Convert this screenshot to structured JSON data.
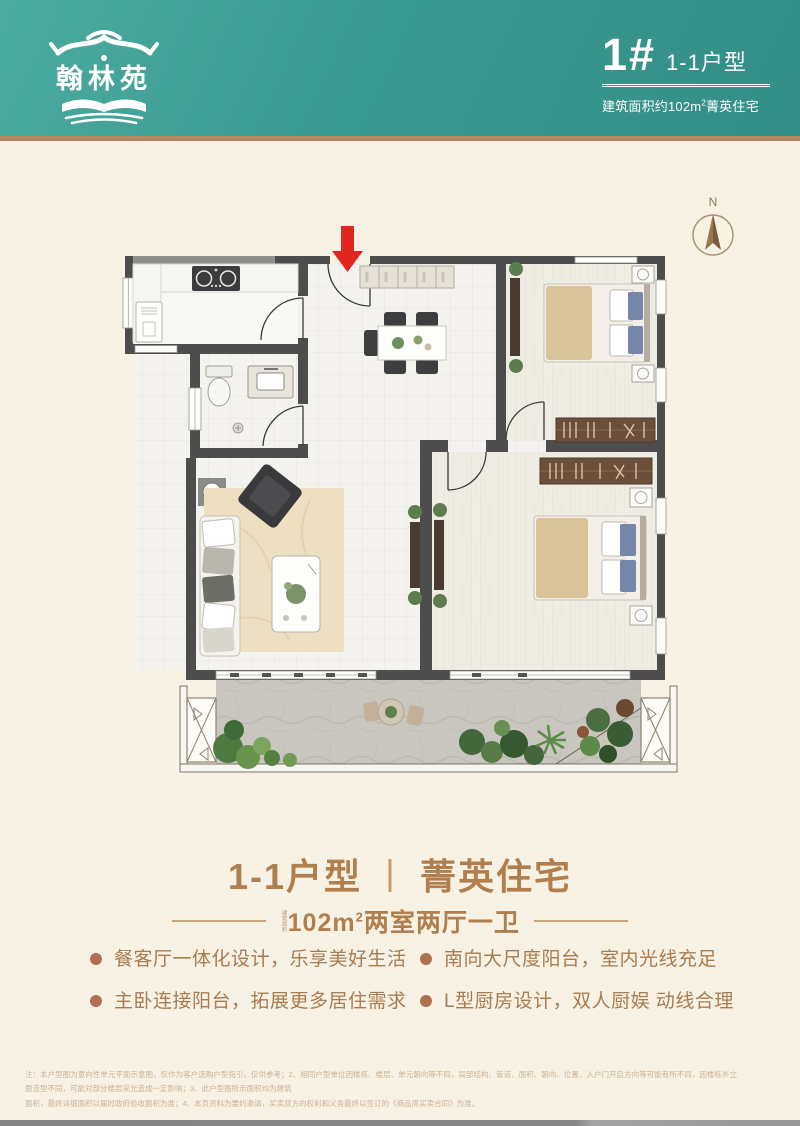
{
  "header": {
    "logo_text": "翰林苑",
    "unit_number": "1#",
    "unit_type": "1-1户型",
    "area_prefix": "建筑面积约102m",
    "area_sup": "2",
    "area_suffix": "菁英住宅"
  },
  "compass": {
    "north": "N"
  },
  "title_block": {
    "name": "1-1户型",
    "divider": "丨",
    "tagline": "菁英住宅",
    "spec_note": "建筑面积",
    "spec_area": "102m",
    "spec_sup": "2",
    "spec_rooms": "两室两厅一卫"
  },
  "features": [
    "餐客厅一体化设计，乐享美好生活",
    "南向大尺度阳台，室内光线充足",
    "主卧连接阳台，拓展更多居住需求",
    "L型厨房设计，双人厨娱 动线合理"
  ],
  "disclaimer": {
    "line1": "注：本户型图为意向性单元平面示意图，仅作为客户选购户型指引，仅供参考；2、相同户型单位因楼栋、楼层、单元朝向等不同，局部结构、管道、面积、朝向、位置、入户门开启方向等可能有所不同，因楼栋外立面造型不同，可能对部分楼层采光造成一定影响；3、此户型图所示面积均为建筑",
    "line2": "面积，最终详细面积以届时政府验收面积为准；4、本页资料为要约邀请，买卖双方的权利和义务最终以签订的《商品房买卖合同》为准。"
  },
  "colors": {
    "teal": "#3b9a90",
    "tan_line": "#b5885f",
    "cream": "#f8f2e5",
    "brown_title": "#b17e4e",
    "bullet": "#b06e52",
    "red_arrow": "#e2261f",
    "wall": "#4d4d4d"
  }
}
